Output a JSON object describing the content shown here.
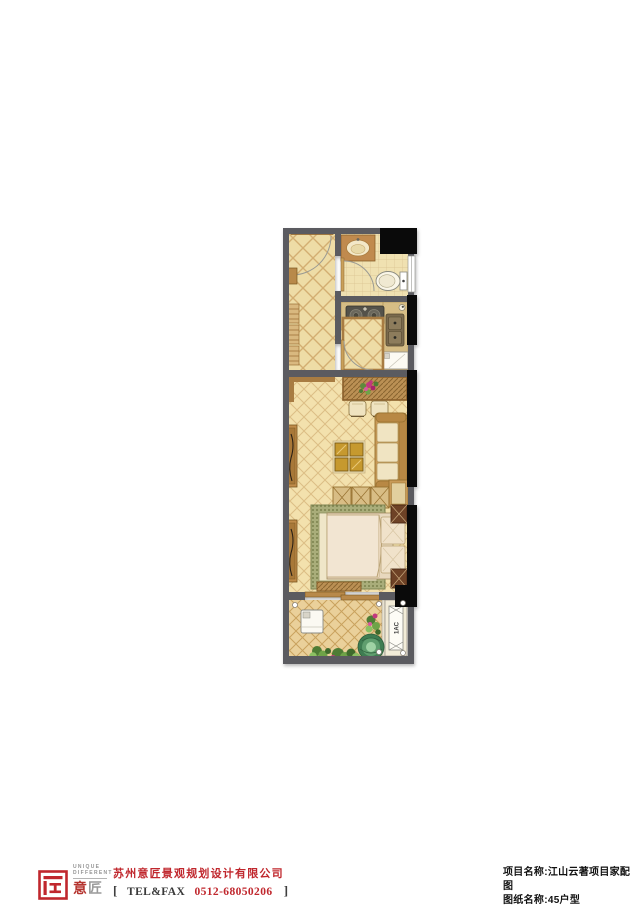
{
  "floor_plan": {
    "ac_label": "1AC",
    "colors": {
      "wall_gray": "#5b5b60",
      "shaft_black": "#0a0a0a",
      "corridor_tile": "#eedca6",
      "tile_line": "#d3ae72",
      "bath_floor": "#f0e1b1",
      "living_floor": "#f3e1ad",
      "balcony_floor": "#ead09a",
      "wood_dark": "#a06c30",
      "wood_mid": "#c08c4a",
      "counter_tan": "#d6bd85",
      "sofa_cream": "#f0e4c2",
      "rug_green": "#a9ad7a",
      "plant_green": "#4e7c35",
      "flower_pink": "#c2387e"
    }
  },
  "footer": {
    "logo": {
      "unique": "UNIQUE",
      "different": "DIFFERENT",
      "cn_first": "意",
      "cn_second": "匠"
    },
    "company_name": "苏州意匠景观规划设计有限公司",
    "tel": {
      "bracket_open": "[",
      "label": "TEL&FAX",
      "number": "0512-68050206",
      "bracket_close": "]"
    }
  },
  "titleblock": {
    "project_line": "项目名称:江山云著项目家配图",
    "sheet_line": "图纸名称:45户型"
  }
}
